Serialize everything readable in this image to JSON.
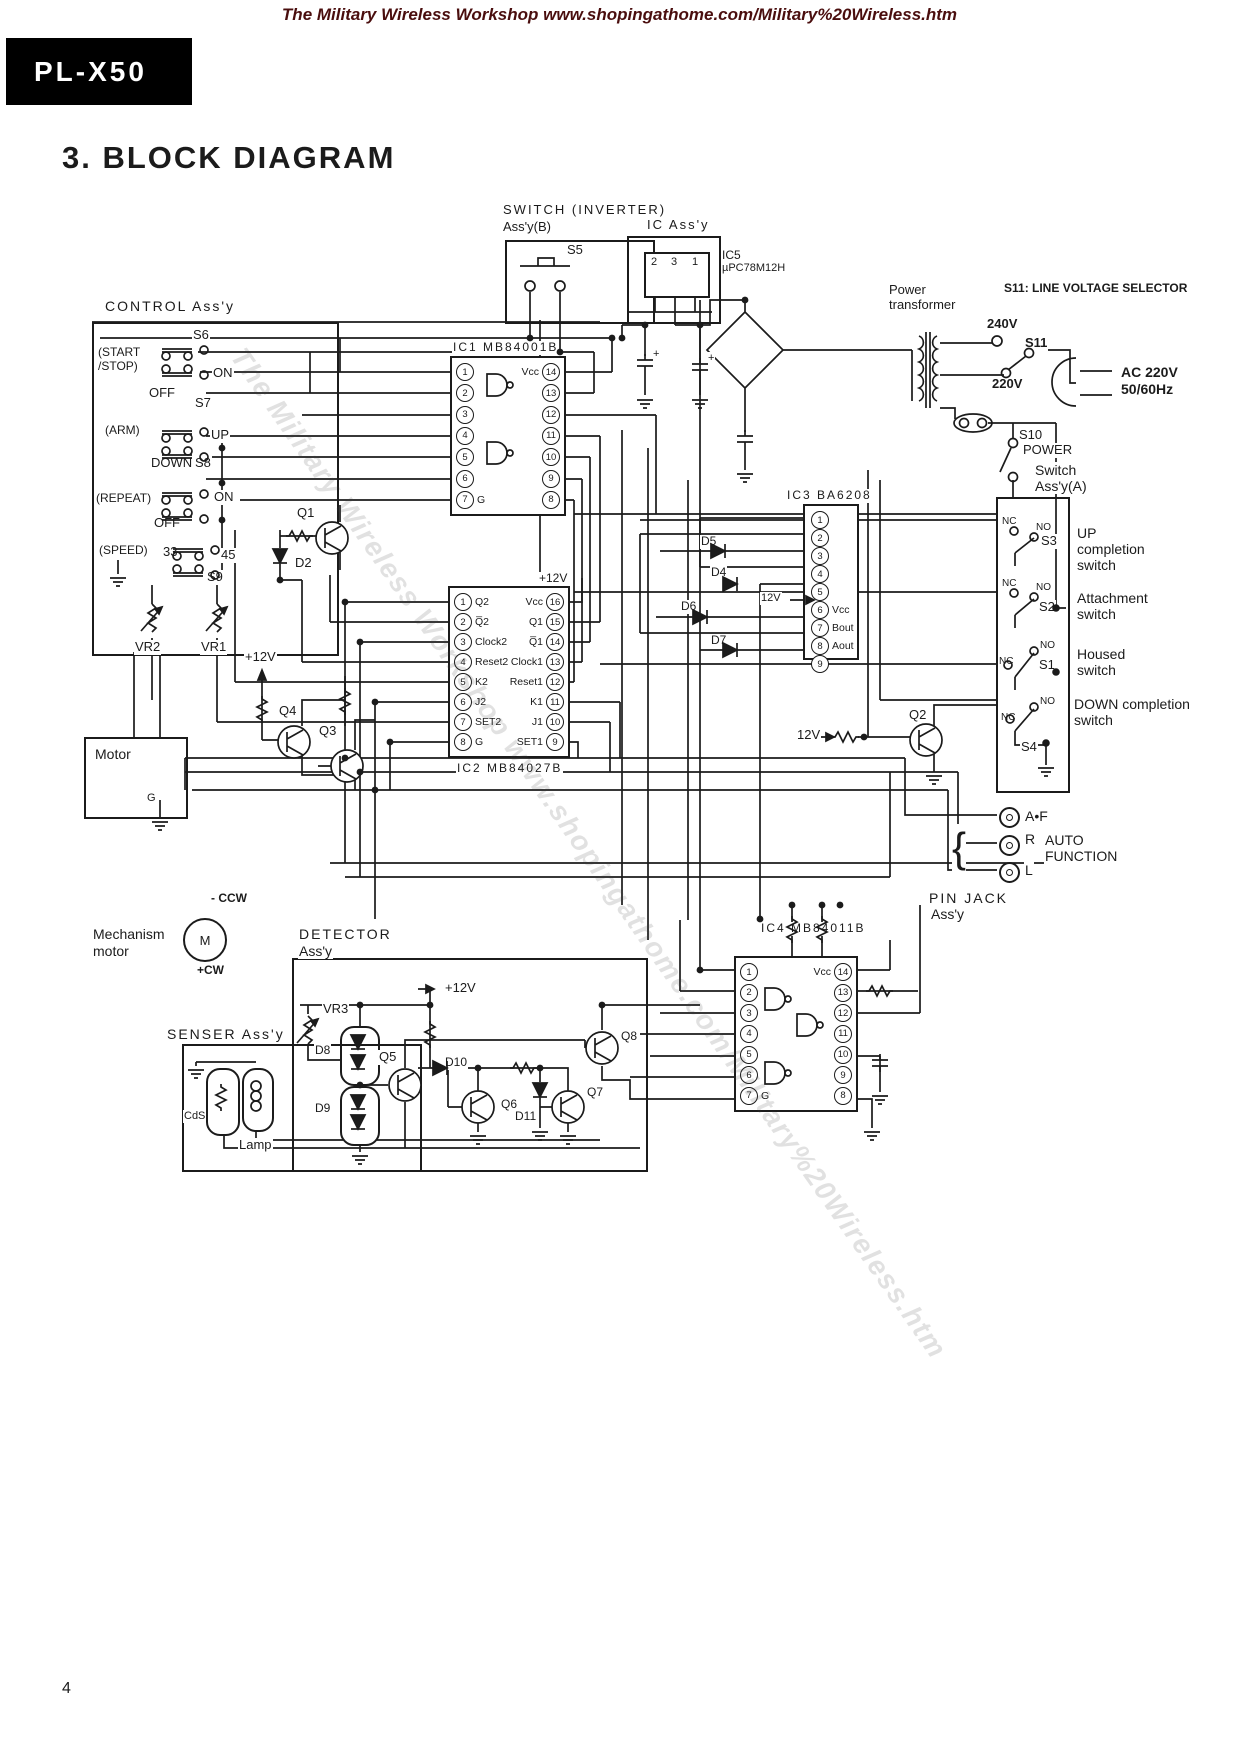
{
  "page": {
    "header": "The Military Wireless Workshop www.shopingathome.com/Military%20Wireless.htm",
    "watermark": "The Military Wireless Workshop www.shopingathome.com/Military%20Wireless.htm",
    "model": "PL-X50",
    "title": "3. BLOCK DIAGRAM",
    "page_number": "4",
    "ink_color": "#1b1b1b",
    "header_color": "#4a0e0e"
  },
  "top": {
    "inverter_title": "SWITCH (INVERTER)",
    "inverter_sub": "Ass'y(B)",
    "s5": "S5",
    "ic_assy_title": "IC Ass'y",
    "ic5_ref": "IC5",
    "ic5_part": "µPC78M12H",
    "ic5_pins": [
      "2",
      "3",
      "1"
    ],
    "power_1": "Power",
    "power_2": "transformer",
    "selector_note": "S11: LINE VOLTAGE SELECTOR",
    "v240": "240V",
    "s11": "S11",
    "v220": "220V",
    "ac_line1": "AC 220V",
    "ac_line2": "50/60Hz",
    "s10": "S10",
    "power_switch": "POWER",
    "switch_a_1": "Switch",
    "switch_a_2": "Ass'y(A)",
    "plus1": "+",
    "plus2": "+"
  },
  "control": {
    "title": "CONTROL Ass'y",
    "start_1": "(START",
    "start_2": "/STOP)",
    "s6": "S6",
    "s6_on": "ON",
    "s6_off": "OFF",
    "arm": "(ARM)",
    "s7": "S7",
    "s7_up": "UP",
    "s7_down": "DOWN",
    "repeat": "(REPEAT)",
    "s8": "S8",
    "s8_on": "ON",
    "s8_off": "OFF",
    "speed": "(SPEED)",
    "n33": "33",
    "n45": "45",
    "s9": "S9",
    "vr2": "VR2",
    "vr1": "VR1",
    "plus12": "+12V",
    "q1": "Q1",
    "d2": "D2",
    "q4": "Q4",
    "q3": "Q3",
    "motor": "Motor",
    "motor_g": "G"
  },
  "ic1": {
    "title": "IC1 MB84001B",
    "rows": [
      {
        "ln": "1",
        "ll": "",
        "rl": "Vcc",
        "rn": "14"
      },
      {
        "ln": "2",
        "ll": "",
        "rl": "",
        "rn": "13"
      },
      {
        "ln": "3",
        "ll": "",
        "rl": "",
        "rn": "12"
      },
      {
        "ln": "4",
        "ll": "",
        "rl": "",
        "rn": "11"
      },
      {
        "ln": "5",
        "ll": "",
        "rl": "",
        "rn": "10"
      },
      {
        "ln": "6",
        "ll": "",
        "rl": "",
        "rn": "9"
      },
      {
        "ln": "7",
        "ll": "G",
        "rl": "",
        "rn": "8"
      }
    ]
  },
  "ic2": {
    "title": "IC2 MB84027B",
    "plus12": "+12V",
    "rows": [
      {
        "ln": "1",
        "ll": "Q2",
        "rl": "Vcc",
        "rn": "16"
      },
      {
        "ln": "2",
        "ll": "Q̅2",
        "rl": "Q1",
        "rn": "15"
      },
      {
        "ln": "3",
        "ll": "Clock2",
        "rl": "Q̅1",
        "rn": "14"
      },
      {
        "ln": "4",
        "ll": "Reset2",
        "rl": "Clock1",
        "rn": "13"
      },
      {
        "ln": "5",
        "ll": "K2",
        "rl": "Reset1",
        "rn": "12"
      },
      {
        "ln": "6",
        "ll": "J2",
        "rl": "K1",
        "rn": "11"
      },
      {
        "ln": "7",
        "ll": "SET2",
        "rl": "J1",
        "rn": "10"
      },
      {
        "ln": "8",
        "ll": "G",
        "rl": "SET1",
        "rn": "9"
      }
    ]
  },
  "ic3": {
    "title": "IC3 BA6208",
    "v12": "12V",
    "pins": [
      {
        "n": "1",
        "l": ""
      },
      {
        "n": "2",
        "l": ""
      },
      {
        "n": "3",
        "l": ""
      },
      {
        "n": "4",
        "l": ""
      },
      {
        "n": "5",
        "l": ""
      },
      {
        "n": "6",
        "l": "Vcc"
      },
      {
        "n": "7",
        "l": "Bout"
      },
      {
        "n": "8",
        "l": "Aout"
      },
      {
        "n": "9",
        "l": ""
      }
    ],
    "d5": "D5",
    "d4": "D4",
    "d6": "D6",
    "d7": "D7"
  },
  "ic4": {
    "title": "IC4 MB84011B",
    "rows": [
      {
        "ln": "1",
        "ll": "",
        "rl": "Vcc",
        "rn": "14"
      },
      {
        "ln": "2",
        "ll": "",
        "rl": "",
        "rn": "13"
      },
      {
        "ln": "3",
        "ll": "",
        "rl": "",
        "rn": "12"
      },
      {
        "ln": "4",
        "ll": "",
        "rl": "",
        "rn": "11"
      },
      {
        "ln": "5",
        "ll": "",
        "rl": "",
        "rn": "10"
      },
      {
        "ln": "6",
        "ll": "",
        "rl": "",
        "rn": "9"
      },
      {
        "ln": "7",
        "ll": "G",
        "rl": "",
        "rn": "8"
      }
    ]
  },
  "switch_a": {
    "q2": "Q2",
    "v12": "12V",
    "s3": {
      "id": "S3",
      "nc": "NC",
      "no": "NO",
      "l1": "UP",
      "l2": "completion",
      "l3": "switch"
    },
    "s2": {
      "id": "S2",
      "nc": "NC",
      "no": "NO",
      "l1": "Attachment",
      "l2": "switch"
    },
    "s1": {
      "id": "S1",
      "nc": "NC",
      "no": "NO",
      "l1": "Housed",
      "l2": "switch"
    },
    "s4": {
      "id": "S4",
      "nc": "NC",
      "no": "NO",
      "l1": "DOWN completion",
      "l2": "switch"
    }
  },
  "pinjack": {
    "af": "A•F",
    "r": "R",
    "auto_1": "AUTO",
    "auto_2": "FUNCTION",
    "l": "L",
    "title_1": "PIN JACK",
    "title_2": "Ass'y"
  },
  "mech": {
    "label_1": "Mechanism",
    "label_2": "motor",
    "m": "M",
    "ccw": "- CCW",
    "cw": "+CW"
  },
  "detector": {
    "title_1": "DETECTOR",
    "title_2": "Ass'y",
    "plus12_rail": "+12V",
    "vr3": "VR3",
    "d8": "D8",
    "d9": "D9",
    "q5": "Q5",
    "d10": "D10",
    "q6": "Q6",
    "d11": "D11",
    "q7": "Q7",
    "q8": "Q8"
  },
  "senser": {
    "title": "SENSER Ass'y",
    "cds": "CdS",
    "lamp": "Lamp"
  }
}
